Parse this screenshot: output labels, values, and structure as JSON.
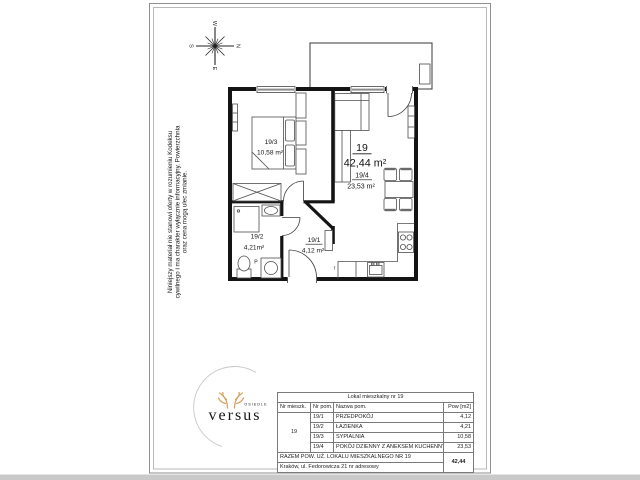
{
  "compass": {
    "north": "N",
    "south": "S",
    "east": "E",
    "west": "W"
  },
  "disclaimer": {
    "line1": "Niniejszy materiał nie stanowi oferty w rozumieniu Kodeksu",
    "line2": "cywilnego i ma charakter wyłącznie informacyjny. Powierzchnia",
    "line3": "oraz cena mogą ulec zmianie."
  },
  "plan": {
    "apartment_no": "19",
    "apartment_area": "42,44 m²",
    "rooms": {
      "bedroom": {
        "no": "19/3",
        "area": "10,58 m²"
      },
      "living": {
        "no": "19/4",
        "area": "23,53 m²"
      },
      "bathroom": {
        "no": "19/2",
        "area": "4,21m²"
      },
      "hall": {
        "no": "19/1",
        "area": "4,12 m²"
      }
    },
    "washer_label": "P",
    "entry_mark": "r"
  },
  "logo": {
    "brand": "versus",
    "tagline": "OSIEDLE"
  },
  "colors": {
    "antlers_gold": "#d8a35e"
  },
  "table": {
    "title": "Lokal mieszkalny nr 19",
    "headers": [
      "Nr mieszk.",
      "Nr pom.",
      "Nazwa pom.",
      "Pow [m2]"
    ],
    "apartment_no": "19",
    "rows": [
      {
        "nr": "19/1",
        "name": "PRZEDPOKÓJ",
        "area": "4,12"
      },
      {
        "nr": "19/2",
        "name": "ŁAZIENKA",
        "area": "4,21"
      },
      {
        "nr": "19/3",
        "name": "SYPIALNIA",
        "area": "10,58"
      },
      {
        "nr": "19/4",
        "name": "POKÓJ DZIENNY Z ANEKSEM KUCHENNYM",
        "area": "23,53"
      }
    ],
    "total_label": "RAZEM POW. UŻ. LOKALU MIESZKALNEGO NR 19",
    "total_area": "42,44",
    "address": "Kraków, ul. Fedorowicza 21 nr adresowy"
  }
}
